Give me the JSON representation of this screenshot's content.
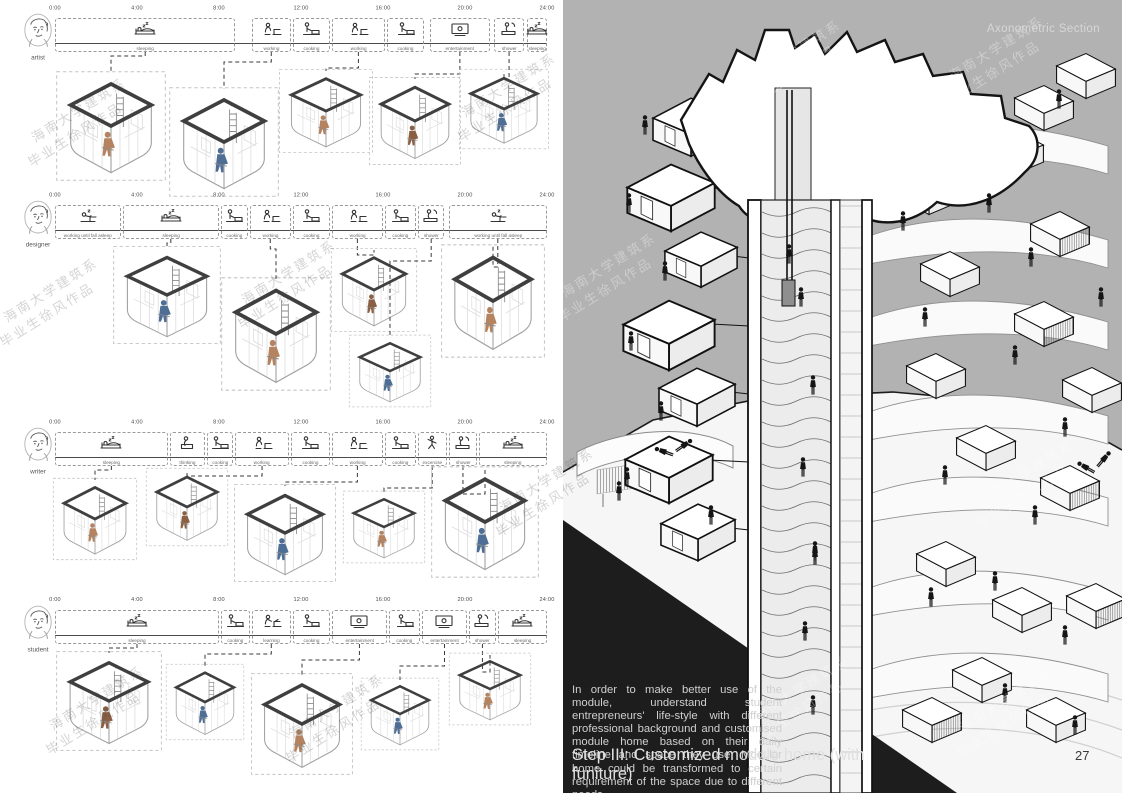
{
  "page": {
    "right_header": "Axonometric Section",
    "page_number": "27"
  },
  "watermark": {
    "line1": "海南大学建筑系",
    "line2": "毕业生徐风作品"
  },
  "caption": {
    "body": "In order to make better use of the module, understand student entrepreneurs' life-style with different professional background and customised module home based on their daily timeline and space they use. Modular home could be transformed to certain requirement of the space due to different needs.",
    "title": "Step III: Customized module home (with funiture)"
  },
  "timelines": [
    {
      "user": "artist",
      "line_y": 43,
      "times": [
        "0:00",
        "4:00",
        "8:00",
        "12:00",
        "16:00",
        "20:00",
        "24:00"
      ],
      "activities": [
        {
          "label": "sleeping",
          "icon": "bed",
          "s": 0,
          "e": 8.8
        },
        {
          "label": "working",
          "icon": "work",
          "s": 9.6,
          "e": 11.5
        },
        {
          "label": "cooking",
          "icon": "cook",
          "s": 11.6,
          "e": 13.4
        },
        {
          "label": "working",
          "icon": "work",
          "s": 13.5,
          "e": 16.1
        },
        {
          "label": "cooking",
          "icon": "cook",
          "s": 16.2,
          "e": 18.0
        },
        {
          "label": "entertainment",
          "icon": "screen",
          "s": 18.3,
          "e": 21.2
        },
        {
          "label": "shower",
          "icon": "shower",
          "s": 21.4,
          "e": 22.9
        },
        {
          "label": "sleeping",
          "icon": "bed",
          "s": 23.0,
          "e": 24.0
        }
      ],
      "links": [
        0,
        1,
        3,
        5,
        6
      ],
      "modules": [
        [
          55,
          70,
          112,
          112
        ],
        [
          168,
          86,
          112,
          112
        ],
        [
          278,
          68,
          96,
          86
        ],
        [
          368,
          76,
          94,
          90
        ],
        [
          458,
          68,
          92,
          82
        ]
      ]
    },
    {
      "user": "designer",
      "line_y": 230,
      "times": [
        "0:00",
        "4:00",
        "8:00",
        "12:00",
        "16:00",
        "20:00",
        "24:00"
      ],
      "activities": [
        {
          "label": "working until fall asleep",
          "icon": "wsleep",
          "s": 0,
          "e": 3.2
        },
        {
          "label": "sleeping",
          "icon": "bed",
          "s": 3.3,
          "e": 8.0
        },
        {
          "label": "cooking",
          "icon": "cook",
          "s": 8.1,
          "e": 9.4
        },
        {
          "label": "working",
          "icon": "work",
          "s": 9.5,
          "e": 11.5
        },
        {
          "label": "cooking",
          "icon": "cook",
          "s": 11.6,
          "e": 13.4
        },
        {
          "label": "working",
          "icon": "work",
          "s": 13.5,
          "e": 16.0
        },
        {
          "label": "cooking",
          "icon": "cook",
          "s": 16.1,
          "e": 17.6
        },
        {
          "label": "shower",
          "icon": "shower",
          "s": 17.7,
          "e": 19.0
        },
        {
          "label": "working until fall asleep",
          "icon": "wsleep",
          "s": 19.2,
          "e": 24.0
        }
      ],
      "links": [
        1,
        3,
        5,
        7,
        8
      ],
      "modules": [
        [
          112,
          245,
          110,
          100
        ],
        [
          220,
          276,
          112,
          116
        ],
        [
          330,
          247,
          88,
          86
        ],
        [
          348,
          334,
          84,
          74
        ],
        [
          440,
          243,
          106,
          116
        ]
      ]
    },
    {
      "user": "writer",
      "line_y": 457,
      "times": [
        "0:00",
        "4:00",
        "8:00",
        "12:00",
        "16:00",
        "20:00",
        "24:00"
      ],
      "activities": [
        {
          "label": "sleeping",
          "icon": "bed",
          "s": 0,
          "e": 5.5
        },
        {
          "label": "thinking",
          "icon": "think",
          "s": 5.6,
          "e": 7.3
        },
        {
          "label": "cooking",
          "icon": "cook",
          "s": 7.4,
          "e": 8.7
        },
        {
          "label": "working",
          "icon": "work",
          "s": 8.8,
          "e": 11.4
        },
        {
          "label": "cooking",
          "icon": "cook",
          "s": 11.5,
          "e": 13.4
        },
        {
          "label": "working",
          "icon": "work",
          "s": 13.5,
          "e": 16.0
        },
        {
          "label": "cooking",
          "icon": "cook",
          "s": 16.1,
          "e": 17.6
        },
        {
          "label": "excercise",
          "icon": "ex",
          "s": 17.7,
          "e": 19.1
        },
        {
          "label": "shower",
          "icon": "shower",
          "s": 19.2,
          "e": 20.6
        },
        {
          "label": "sleeping",
          "icon": "bed",
          "s": 20.7,
          "e": 24.0
        }
      ],
      "links": [
        0,
        3,
        5,
        7,
        8
      ],
      "modules": [
        [
          52,
          477,
          86,
          84
        ],
        [
          145,
          467,
          84,
          80
        ],
        [
          233,
          483,
          104,
          100
        ],
        [
          342,
          490,
          84,
          74
        ],
        [
          430,
          465,
          110,
          114
        ]
      ]
    },
    {
      "user": "student",
      "line_y": 635,
      "times": [
        "0:00",
        "4:00",
        "8:00",
        "12:00",
        "16:00",
        "20:00",
        "24:00"
      ],
      "activities": [
        {
          "label": "sleeping",
          "icon": "bed",
          "s": 0,
          "e": 8.0
        },
        {
          "label": "cooking",
          "icon": "cook",
          "s": 8.1,
          "e": 9.5
        },
        {
          "label": "learning",
          "icon": "learn",
          "s": 9.6,
          "e": 11.5
        },
        {
          "label": "cooking",
          "icon": "cook",
          "s": 11.6,
          "e": 13.4
        },
        {
          "label": "entertainment",
          "icon": "screen",
          "s": 13.5,
          "e": 16.2
        },
        {
          "label": "cooking",
          "icon": "cook",
          "s": 16.3,
          "e": 17.8
        },
        {
          "label": "entertainment",
          "icon": "screen",
          "s": 17.9,
          "e": 20.1
        },
        {
          "label": "shower",
          "icon": "shower",
          "s": 20.2,
          "e": 21.5
        },
        {
          "label": "sleeping",
          "icon": "bed",
          "s": 21.6,
          "e": 24.0
        }
      ],
      "links": [
        0,
        2,
        4,
        6,
        7
      ],
      "modules": [
        [
          55,
          650,
          108,
          102
        ],
        [
          165,
          663,
          80,
          78
        ],
        [
          250,
          672,
          104,
          104
        ],
        [
          360,
          677,
          80,
          74
        ],
        [
          448,
          652,
          84,
          74
        ]
      ]
    }
  ]
}
